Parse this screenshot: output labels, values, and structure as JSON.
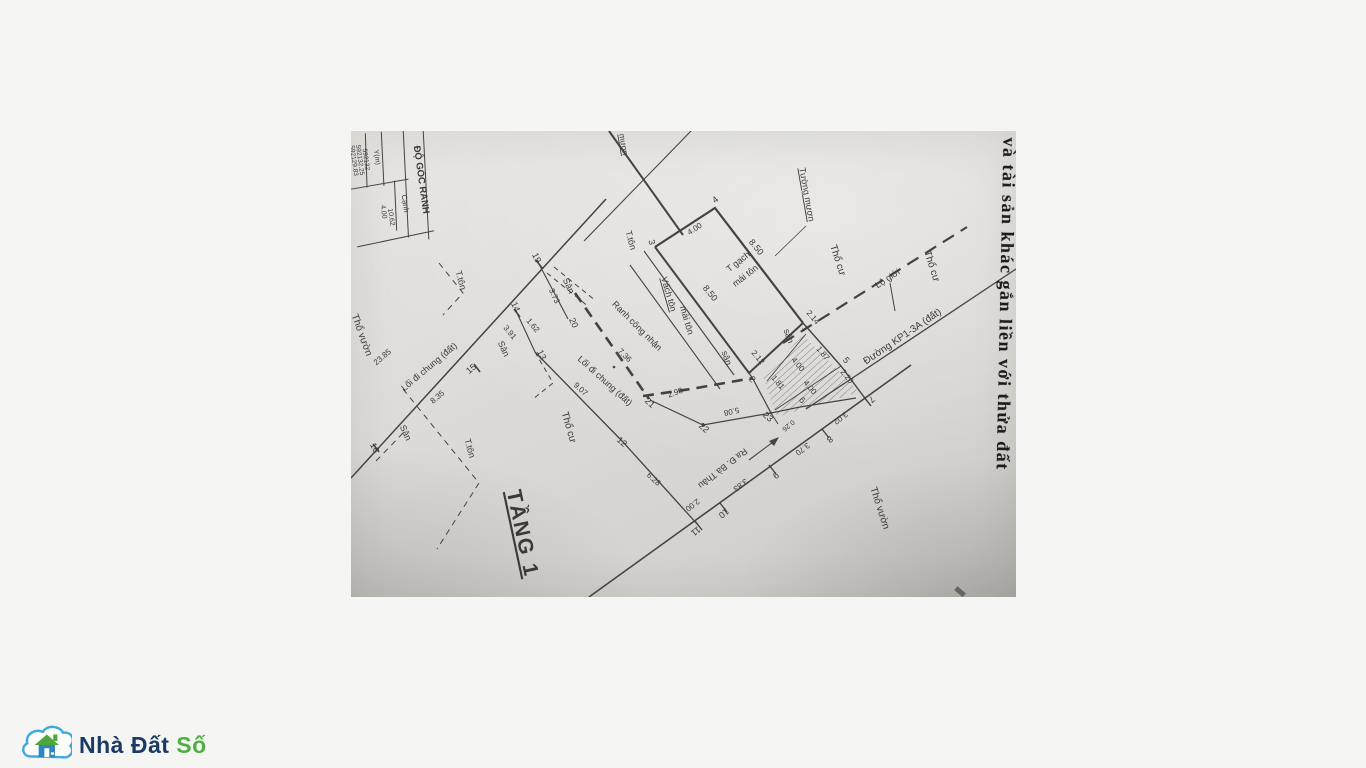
{
  "page": {
    "background": "#f5f5f4"
  },
  "watermark": {
    "name_part1": "Nhà Đất",
    "name_part2": "Số",
    "cloud_color": "#3fa9dc",
    "house_body_color": "#2e86c1",
    "roof_color": "#4da839",
    "text1_color": "#1b3b66",
    "text2_color": "#4eb03f"
  },
  "scan": {
    "side_text": "ở và tài sản khác gắn liền với thửa đất",
    "table": {
      "title": "ĐỘ GÓC RANH",
      "col_y": "Y(m)",
      "col_canh": "Cạnh",
      "y_values": [
        "592129.83",
        "592132.25",
        "592132"
      ],
      "canh_values": [
        "4.00",
        "10.62"
      ]
    },
    "labels": [
      {
        "text": "mượn",
        "x": 270,
        "y": 14,
        "r": 80,
        "fs": 8,
        "u": 1
      },
      {
        "text": "Tường mượn",
        "x": 453,
        "y": 64,
        "r": 80,
        "fs": 9,
        "u": 1
      },
      {
        "text": "Thổ cư",
        "x": 484,
        "y": 130,
        "r": 72,
        "fs": 10
      },
      {
        "text": "Thổ cư",
        "x": 578,
        "y": 136,
        "r": 72,
        "fs": 10
      },
      {
        "text": "Lộ giới",
        "x": 538,
        "y": 150,
        "r": -33,
        "fs": 9
      },
      {
        "text": "Đường KP1-3A (đất)",
        "x": 553,
        "y": 208,
        "r": -34,
        "fs": 10
      },
      {
        "text": "Thổ cư",
        "x": 215,
        "y": 297,
        "r": 74,
        "fs": 10
      },
      {
        "text": "Thổ vườn",
        "x": 8,
        "y": 205,
        "r": 70,
        "fs": 10
      },
      {
        "text": "Thổ vườn",
        "x": 526,
        "y": 378,
        "r": 72,
        "fs": 10
      },
      {
        "text": "T gạch",
        "x": 389,
        "y": 133,
        "r": -38,
        "fs": 9
      },
      {
        "text": "mái tôn",
        "x": 396,
        "y": 147,
        "r": -38,
        "fs": 9
      },
      {
        "text": "T.tôn",
        "x": 277,
        "y": 110,
        "r": 74,
        "fs": 9
      },
      {
        "text": "Vách tôn",
        "x": 315,
        "y": 164,
        "r": 74,
        "fs": 9,
        "u": 1
      },
      {
        "text": "mái tôn",
        "x": 333,
        "y": 190,
        "r": 74,
        "fs": 9
      },
      {
        "text": "T.tôn",
        "x": 107,
        "y": 150,
        "r": 74,
        "fs": 9
      },
      {
        "text": "T.tôn",
        "x": 116,
        "y": 318,
        "r": 74,
        "fs": 9
      },
      {
        "text": "Sân",
        "x": 215,
        "y": 156,
        "r": 65,
        "fs": 9
      },
      {
        "text": "sân",
        "x": 373,
        "y": 228,
        "r": 70,
        "fs": 9
      },
      {
        "text": "sân",
        "x": 435,
        "y": 206,
        "r": 70,
        "fs": 9
      },
      {
        "text": "Sân",
        "x": 150,
        "y": 219,
        "r": 65,
        "fs": 9
      },
      {
        "text": "Sân",
        "x": 52,
        "y": 303,
        "r": 65,
        "fs": 9
      },
      {
        "text": "Ranh công nhận",
        "x": 284,
        "y": 197,
        "r": 45,
        "fs": 9
      },
      {
        "text": "Lối đi chung (đất)",
        "x": 80,
        "y": 238,
        "r": -40,
        "fs": 9
      },
      {
        "text": "Lối đi chung (đất)",
        "x": 252,
        "y": 252,
        "r": 42,
        "fs": 9
      },
      {
        "text": "Ra Đ. Bà Thâu",
        "x": 370,
        "y": 335,
        "r": 142,
        "fs": 9
      },
      {
        "text": "TẦNG 1",
        "x": 165,
        "y": 404,
        "r": 78,
        "fs": 21,
        "u": 1,
        "b": 1
      },
      {
        "text": "8.50",
        "x": 403,
        "y": 118,
        "r": 50,
        "fs": 9
      },
      {
        "text": "8.50",
        "x": 357,
        "y": 164,
        "r": 50,
        "fs": 9
      },
      {
        "text": "4.00",
        "x": 345,
        "y": 100,
        "r": -33,
        "fs": 8
      },
      {
        "text": "3.73",
        "x": 201,
        "y": 166,
        "r": 65,
        "fs": 8
      },
      {
        "text": "7.36",
        "x": 272,
        "y": 226,
        "r": 45,
        "fs": 8
      },
      {
        "text": "2.98",
        "x": 325,
        "y": 264,
        "r": -20,
        "fs": 8
      },
      {
        "text": "5.08",
        "x": 380,
        "y": 278,
        "r": 168,
        "fs": 8
      },
      {
        "text": "9.07",
        "x": 228,
        "y": 260,
        "r": 42,
        "fs": 8
      },
      {
        "text": "6.28",
        "x": 301,
        "y": 350,
        "r": 42,
        "fs": 8
      },
      {
        "text": "23.85",
        "x": 33,
        "y": 228,
        "r": -40,
        "fs": 8
      },
      {
        "text": "3.91",
        "x": 157,
        "y": 203,
        "r": 50,
        "fs": 8
      },
      {
        "text": "1.62",
        "x": 180,
        "y": 196,
        "r": 50,
        "fs": 8
      },
      {
        "text": "8.35",
        "x": 88,
        "y": 268,
        "r": -40,
        "fs": 8
      },
      {
        "text": "2.00",
        "x": 340,
        "y": 372,
        "r": 142,
        "fs": 8
      },
      {
        "text": "3.83",
        "x": 388,
        "y": 352,
        "r": 142,
        "fs": 8
      },
      {
        "text": "3.70",
        "x": 450,
        "y": 316,
        "r": 142,
        "fs": 8
      },
      {
        "text": "3.02",
        "x": 488,
        "y": 285,
        "r": 142,
        "fs": 8
      },
      {
        "text": "2.14",
        "x": 460,
        "y": 188,
        "r": 50,
        "fs": 8
      },
      {
        "text": "1.87",
        "x": 470,
        "y": 224,
        "r": 50,
        "fs": 8
      },
      {
        "text": "2.26",
        "x": 494,
        "y": 247,
        "r": 50,
        "fs": 8
      },
      {
        "text": "1.81",
        "x": 425,
        "y": 253,
        "r": 50,
        "fs": 8
      },
      {
        "text": "4.00",
        "x": 445,
        "y": 235,
        "r": 50,
        "fs": 8
      },
      {
        "text": "4.00",
        "x": 457,
        "y": 258,
        "r": 50,
        "fs": 8
      },
      {
        "text": "2.12",
        "x": 405,
        "y": 228,
        "r": 50,
        "fs": 8
      },
      {
        "text": "0.26",
        "x": 436,
        "y": 293,
        "r": 140,
        "fs": 7
      },
      {
        "text": "4",
        "x": 366,
        "y": 71,
        "r": -38,
        "fs": 9
      },
      {
        "text": "3",
        "x": 298,
        "y": 112,
        "r": 74,
        "fs": 9
      },
      {
        "text": "19",
        "x": 183,
        "y": 128,
        "r": 65,
        "fs": 9
      },
      {
        "text": "20",
        "x": 220,
        "y": 193,
        "r": 65,
        "fs": 9
      },
      {
        "text": "14",
        "x": 162,
        "y": 177,
        "r": 65,
        "fs": 9
      },
      {
        "text": "13",
        "x": 188,
        "y": 225,
        "r": 65,
        "fs": 9
      },
      {
        "text": "15",
        "x": 122,
        "y": 240,
        "r": -40,
        "fs": 9
      },
      {
        "text": "16",
        "x": 21,
        "y": 318,
        "r": 65,
        "fs": 9
      },
      {
        "text": "21",
        "x": 297,
        "y": 274,
        "r": 42,
        "fs": 9
      },
      {
        "text": "22",
        "x": 351,
        "y": 299,
        "r": 42,
        "fs": 9
      },
      {
        "text": "12",
        "x": 269,
        "y": 313,
        "r": 42,
        "fs": 9
      },
      {
        "text": "11",
        "x": 343,
        "y": 398,
        "r": 142,
        "fs": 9
      },
      {
        "text": "10",
        "x": 371,
        "y": 380,
        "r": 142,
        "fs": 9
      },
      {
        "text": "9",
        "x": 423,
        "y": 342,
        "r": 142,
        "fs": 9
      },
      {
        "text": "8",
        "x": 477,
        "y": 306,
        "r": 142,
        "fs": 9
      },
      {
        "text": "7",
        "x": 519,
        "y": 266,
        "r": 142,
        "fs": 9
      },
      {
        "text": "23",
        "x": 415,
        "y": 288,
        "r": 42,
        "fs": 9
      },
      {
        "text": "6",
        "x": 449,
        "y": 271,
        "r": 50,
        "fs": 9
      },
      {
        "text": "2",
        "x": 399,
        "y": 250,
        "r": 50,
        "fs": 9
      },
      {
        "text": "5",
        "x": 493,
        "y": 231,
        "r": 50,
        "fs": 9
      },
      {
        "text": "1",
        "x": 452,
        "y": 199,
        "r": 50,
        "fs": 8
      }
    ]
  }
}
